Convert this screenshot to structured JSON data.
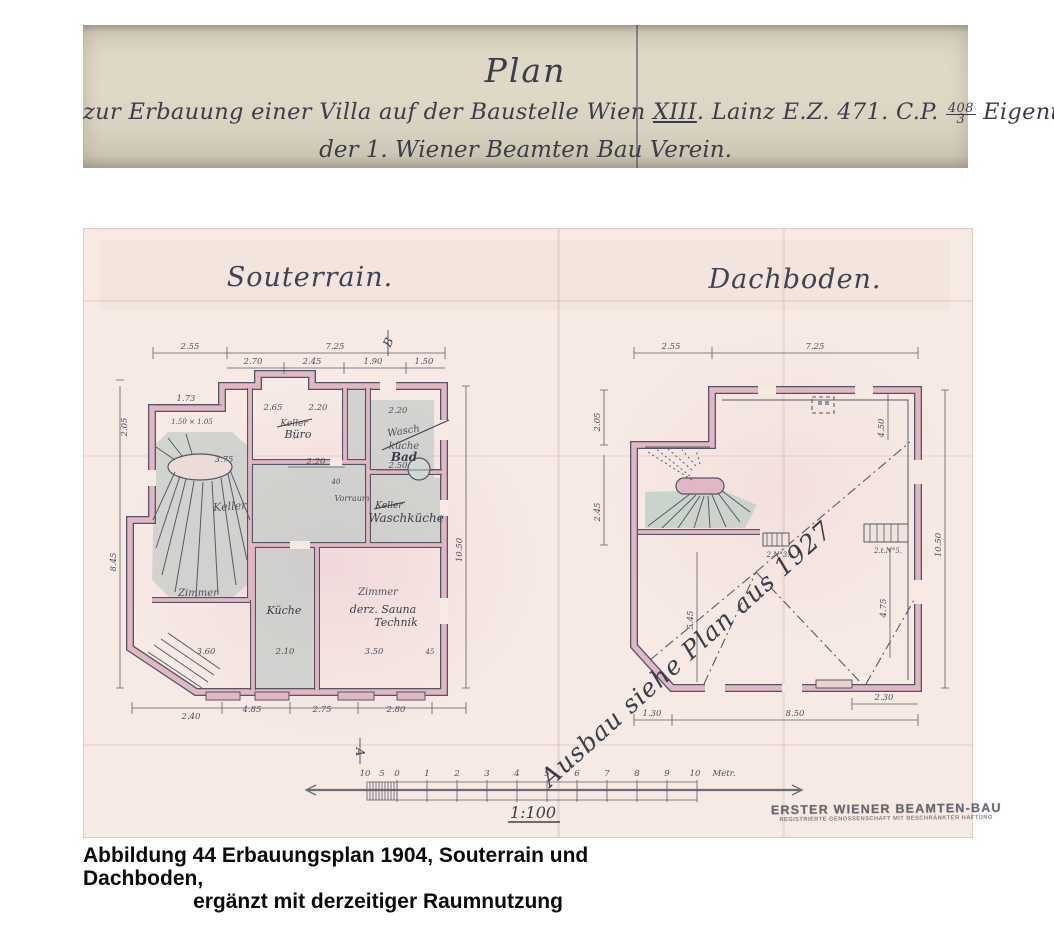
{
  "header": {
    "title": "Plan",
    "line2_pre": "zur Erbauung einer Villa auf der Baustelle Wien ",
    "line2_roman": "XIII",
    "line2_mid": ". Lainz E.Z. 471. C.P. ",
    "line2_frac_top": "408",
    "line2_frac_bottom": "3",
    "line2_post": " Eigentümer",
    "line3": "der 1. Wiener Beamten Bau Verein."
  },
  "sheet": {
    "souterrain": {
      "title": "Souterrain.",
      "rooms": {
        "stair": "Keller",
        "buero_old": "Keller",
        "buero_new": "Büro",
        "bad_old1": "Wasch",
        "bad_old2": "küche",
        "bad_new": "Bad",
        "vorraum": "Vorraum",
        "wk_old": "Keller",
        "wk_new": "Waschküche",
        "zimmer_left": "Zimmer",
        "kueche": "Küche",
        "zimmer_right": "Zimmer",
        "zimmer_right_new1": "derz. Sauna",
        "zimmer_right_new2": "Technik"
      },
      "dims": [
        "2.55",
        "7.25",
        "2.70",
        "2.45",
        "1.90",
        "1.50",
        "1.73",
        "2.05",
        "1.50 × 1.05",
        "8.45",
        "2.65",
        "2.20",
        "2.20",
        "3.75",
        "2.20",
        "40",
        "2.50",
        "3.60",
        "2.10",
        "3.50",
        "45",
        "2.40",
        "4.85",
        "2.75",
        "2.80",
        "10.50"
      ],
      "marker_top": "B",
      "marker_bottom": "A"
    },
    "dachboden": {
      "title": "Dachboden.",
      "annotation": "Ausbau siehe Plan aus 1927",
      "dims": [
        "2.55",
        "7.25",
        "2.05",
        "2.45",
        "4.50",
        "4.75",
        "5.45",
        "1.30",
        "8.50",
        "2.30",
        "10.50"
      ],
      "mark1": "2.N°3.",
      "mark2": "2.t.N°5."
    },
    "scalebar": {
      "ticks": [
        "10",
        "5",
        "0",
        "1",
        "2",
        "3",
        "4",
        "5",
        "6",
        "7",
        "8",
        "9",
        "10"
      ],
      "unit": "Metr.",
      "ratio": "1:100"
    },
    "stamp": {
      "line1": "ERSTER WIENER BEAMTEN-BAU",
      "line2": "REGISTRIERTE GENOSSENSCHAFT MIT BESCHRÄNKTER HAFTUNG"
    }
  },
  "caption": {
    "line1": "Abbildung 44 Erbauungsplan 1904, Souterrain und Dachboden,",
    "line2": "ergänzt mit derzeitiger Raumnutzung"
  },
  "colors": {
    "header_paper": "#ddd6c4",
    "sheet_paper": "#f7eae5",
    "wall_pink": "#e2b7c5",
    "use_shade_gray": "#bcc6c4",
    "ink": "#4e5160",
    "pencil": "#3d424d"
  }
}
